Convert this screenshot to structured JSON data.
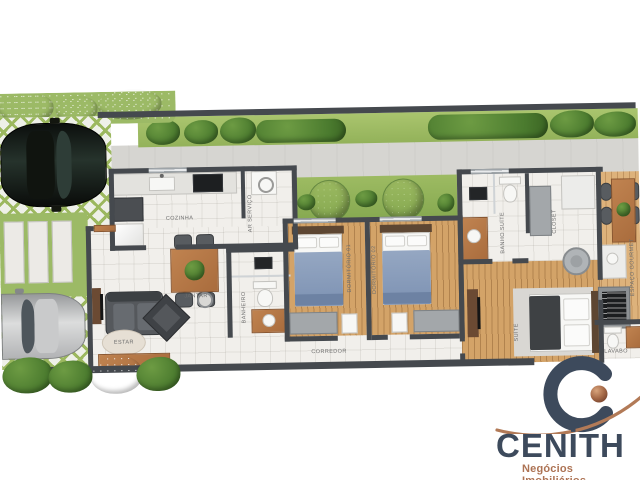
{
  "plan": {
    "room_labels": {
      "cozinha": "COZINHA",
      "ar_servico": "AR SERVIÇO",
      "jantar": "JANTAR",
      "estar": "ESTAR",
      "banheiro": "BANHEIRO",
      "corredor": "CORREDOR",
      "dormitorio_01": "DORMITÓRIO 01",
      "dormitorio_02": "DORMITÓRIO 02",
      "banho_suite": "BANHO SUÍTE",
      "closet": "CLOSET",
      "suite": "SUÍTE",
      "lavabo": "LAVABO",
      "espaco_gourmet": "ESPAÇO GOURMET"
    },
    "palette": {
      "wall": "#45494e",
      "wood_floor": "#d3a368",
      "tile_floor": "#f1efeb",
      "lawn": "#a3c068",
      "paver_green": "#9cba66",
      "sidewalk": "#d6d5d1",
      "label_text": "#6e6e6e"
    }
  },
  "logo": {
    "brand": "CENİTH",
    "tagline": "Negócios Imobiliários",
    "brand_color": "#3d4a5c",
    "accent_color": "#ad7354"
  }
}
